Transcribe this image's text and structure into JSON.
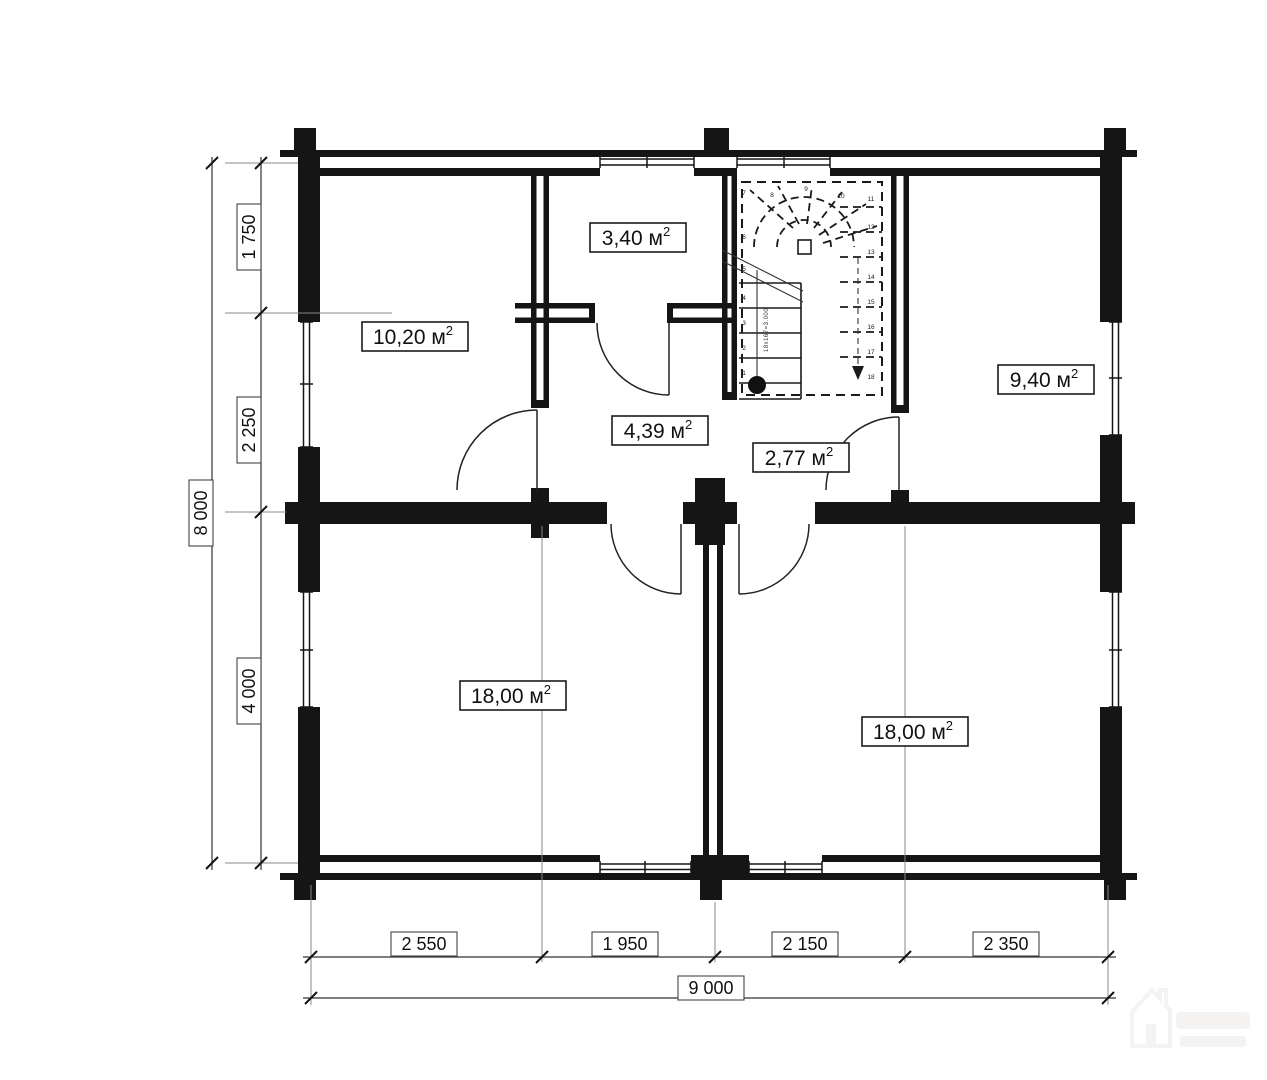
{
  "rooms": [
    {
      "name": "room-3-40",
      "text": "3,40 м",
      "sup": "2"
    },
    {
      "name": "room-10-20",
      "text": "10,20 м",
      "sup": "2"
    },
    {
      "name": "room-9-40",
      "text": "9,40 м",
      "sup": "2"
    },
    {
      "name": "hall-4-39",
      "text": "4,39 м",
      "sup": "2"
    },
    {
      "name": "hall-2-77",
      "text": "2,77 м",
      "sup": "2"
    },
    {
      "name": "room-18-00-left",
      "text": "18,00 м",
      "sup": "2"
    },
    {
      "name": "room-18-00-right",
      "text": "18,00 м",
      "sup": "2"
    }
  ],
  "dims": {
    "left": {
      "segments": [
        "1 750",
        "2 250",
        "4 000"
      ],
      "total": "8 000"
    },
    "bottom": {
      "segments": [
        "2 550",
        "1 950",
        "2 150",
        "2 350"
      ],
      "total": "9 000"
    }
  },
  "stair": {
    "left_numbers": [
      "1",
      "2",
      "3",
      "4",
      "5",
      "6",
      "7"
    ],
    "fan_numbers": [
      "8",
      "9",
      "10"
    ],
    "right_numbers": [
      "11",
      "12",
      "13",
      "14",
      "15",
      "16",
      "17",
      "18"
    ],
    "run_annotation": "18x167=3.000"
  },
  "icons": {
    "watermark": "house-logo-icon"
  },
  "colors": {
    "line": "#151515",
    "dim_line": "#333333",
    "watermark": "#8a8376",
    "background": "#ffffff"
  }
}
